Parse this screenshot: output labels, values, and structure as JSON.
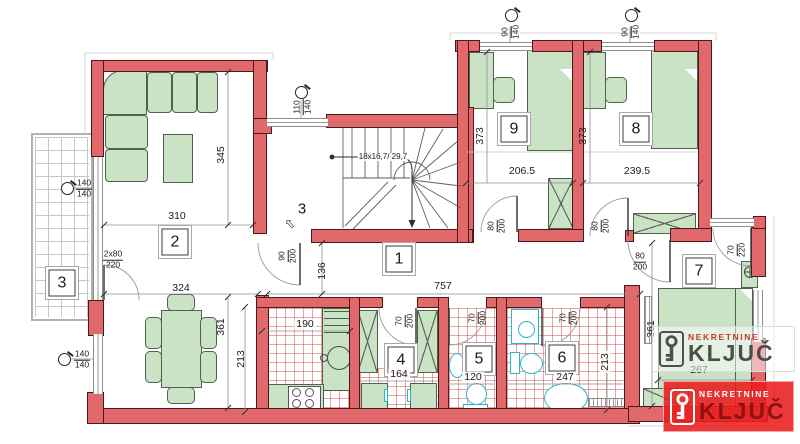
{
  "watermark": {
    "company": "NEKRETNINE",
    "name": "KLJUČ"
  },
  "colors": {
    "wall_fill": "#e2696b",
    "wall_outline": "#4a191b",
    "furniture_fill": "#c9e3c4",
    "fixture_stroke": "#28b6ca",
    "tile_hatch_red": "#d25c5c",
    "tile_hatch_gray": "#c6c6c6",
    "logo_red": "#e91c1c",
    "logo_text_dark": "#4d4d4d"
  },
  "plan": {
    "labels": [
      {
        "name": "room-label-1",
        "x": 399,
        "y": 259,
        "cls": "roombox",
        "text": "1"
      },
      {
        "name": "room-label-2",
        "x": 175,
        "y": 242,
        "cls": "roombox",
        "text": "2"
      },
      {
        "name": "room-label-3",
        "x": 62,
        "y": 283,
        "cls": "roombox",
        "text": "3"
      },
      {
        "name": "room-label-4",
        "x": 401,
        "y": 360,
        "cls": "roombox",
        "text": "4"
      },
      {
        "name": "room-label-5",
        "x": 479,
        "y": 359,
        "cls": "roombox",
        "text": "5"
      },
      {
        "name": "room-label-6",
        "x": 562,
        "y": 358,
        "cls": "roombox",
        "text": "6"
      },
      {
        "name": "room-label-7",
        "x": 699,
        "y": 271,
        "cls": "roombox",
        "text": "7"
      },
      {
        "name": "room-label-8",
        "x": 636,
        "y": 129,
        "cls": "roombox",
        "text": "8"
      },
      {
        "name": "room-label-9",
        "x": 514,
        "y": 129,
        "cls": "roombox",
        "text": "9"
      },
      {
        "name": "entrance-number",
        "x": 302,
        "y": 209,
        "cls": "big",
        "text": "3"
      },
      {
        "name": "entrance-arrow-icon",
        "x": 290,
        "y": 224,
        "cls": "arrowg",
        "tilt": -40,
        "text": "⇧"
      },
      {
        "name": "dim-310",
        "x": 177,
        "y": 216,
        "text": "310"
      },
      {
        "name": "dim-324",
        "x": 181,
        "y": 288,
        "text": "324"
      },
      {
        "name": "dim-345",
        "x": 221,
        "y": 155,
        "rot": true,
        "text": "345"
      },
      {
        "name": "dim-190",
        "x": 305,
        "y": 324,
        "cls": "bg",
        "text": "190"
      },
      {
        "name": "dim-206-5",
        "x": 522,
        "y": 171,
        "text": "206.5"
      },
      {
        "name": "dim-239-5",
        "x": 637,
        "y": 171,
        "text": "239.5"
      },
      {
        "name": "dim-373-left",
        "x": 480,
        "y": 136,
        "rot": true,
        "text": "373"
      },
      {
        "name": "dim-373-right",
        "x": 583,
        "y": 136,
        "rot": true,
        "text": "373"
      },
      {
        "name": "dim-757",
        "x": 443,
        "y": 286,
        "text": "757"
      },
      {
        "name": "dim-136",
        "x": 322,
        "y": 271,
        "rot": true,
        "text": "136"
      },
      {
        "name": "dim-361-left",
        "x": 221,
        "y": 327,
        "rot": true,
        "text": "361"
      },
      {
        "name": "dim-213-left",
        "x": 241,
        "y": 359,
        "rot": true,
        "text": "213"
      },
      {
        "name": "dim-164",
        "x": 399,
        "y": 374,
        "cls": "bg",
        "text": "164"
      },
      {
        "name": "dim-120",
        "x": 473,
        "y": 377,
        "cls": "bg",
        "text": "120"
      },
      {
        "name": "dim-247",
        "x": 565,
        "y": 377,
        "cls": "bg",
        "text": "247"
      },
      {
        "name": "dim-213-right",
        "x": 605,
        "y": 362,
        "rot": true,
        "cls": "bg",
        "text": "213"
      },
      {
        "name": "dim-361-right",
        "x": 651,
        "y": 329,
        "rot": true,
        "text": "361"
      },
      {
        "name": "dim-267",
        "x": 699,
        "y": 370,
        "text": "267"
      },
      {
        "name": "stair-note",
        "x": 383,
        "y": 157,
        "cls": "note",
        "text": "18x16,7/ 29,7"
      },
      {
        "name": "win-dim-110-140",
        "x": 303,
        "y": 107,
        "frac": true,
        "rot": true,
        "top": "110",
        "bot": "140"
      },
      {
        "name": "win-dim-90-140-left",
        "x": 511,
        "y": 32,
        "frac": true,
        "rot": true,
        "top": "90",
        "bot": "140"
      },
      {
        "name": "win-dim-90-140-right",
        "x": 631,
        "y": 32,
        "frac": true,
        "rot": true,
        "top": "90",
        "bot": "140"
      },
      {
        "name": "win-dim-140-140-upper",
        "x": 84,
        "y": 189,
        "frac": true,
        "top": "140",
        "bot": "140"
      },
      {
        "name": "win-dim-140-140-lower",
        "x": 82,
        "y": 360,
        "frac": true,
        "top": "140",
        "bot": "140"
      },
      {
        "name": "door-dim-2x80-220",
        "x": 113,
        "y": 260,
        "frac": true,
        "top": "2x80",
        "bot": "220"
      },
      {
        "name": "door-dim-90-200",
        "x": 288,
        "y": 256,
        "frac": true,
        "rot": true,
        "top": "90",
        "bot": "200"
      },
      {
        "name": "door-dim-80-200-room9",
        "x": 497,
        "y": 226,
        "frac": true,
        "rot": true,
        "top": "80",
        "bot": "200"
      },
      {
        "name": "door-dim-80-200-room8",
        "x": 601,
        "y": 226,
        "frac": true,
        "rot": true,
        "top": "80",
        "bot": "200"
      },
      {
        "name": "door-dim-80-200-room7",
        "x": 640,
        "y": 262,
        "frac": true,
        "top": "80",
        "bot": "200"
      },
      {
        "name": "door-dim-70-200-room4",
        "x": 405,
        "y": 321,
        "frac": true,
        "rot": true,
        "top": "70",
        "bot": "200"
      },
      {
        "name": "door-dim-70-200-room5",
        "x": 478,
        "y": 318,
        "frac": true,
        "rot": true,
        "top": "70",
        "bot": "200"
      },
      {
        "name": "door-dim-70-200-room6",
        "x": 569,
        "y": 318,
        "frac": true,
        "rot": true,
        "top": "70",
        "bot": "200"
      },
      {
        "name": "door-dim-70-220-room7",
        "x": 737,
        "y": 250,
        "frac": true,
        "rot": true,
        "top": "70",
        "bot": "220"
      }
    ],
    "markers": [
      {
        "name": "window-marker-stair",
        "x": 301,
        "y": 92
      },
      {
        "name": "window-marker-room9",
        "x": 511,
        "y": 15
      },
      {
        "name": "window-marker-room8",
        "x": 631,
        "y": 15
      },
      {
        "name": "window-marker-balcony",
        "x": 67,
        "y": 188
      },
      {
        "name": "window-marker-dining",
        "x": 64,
        "y": 359
      }
    ]
  }
}
